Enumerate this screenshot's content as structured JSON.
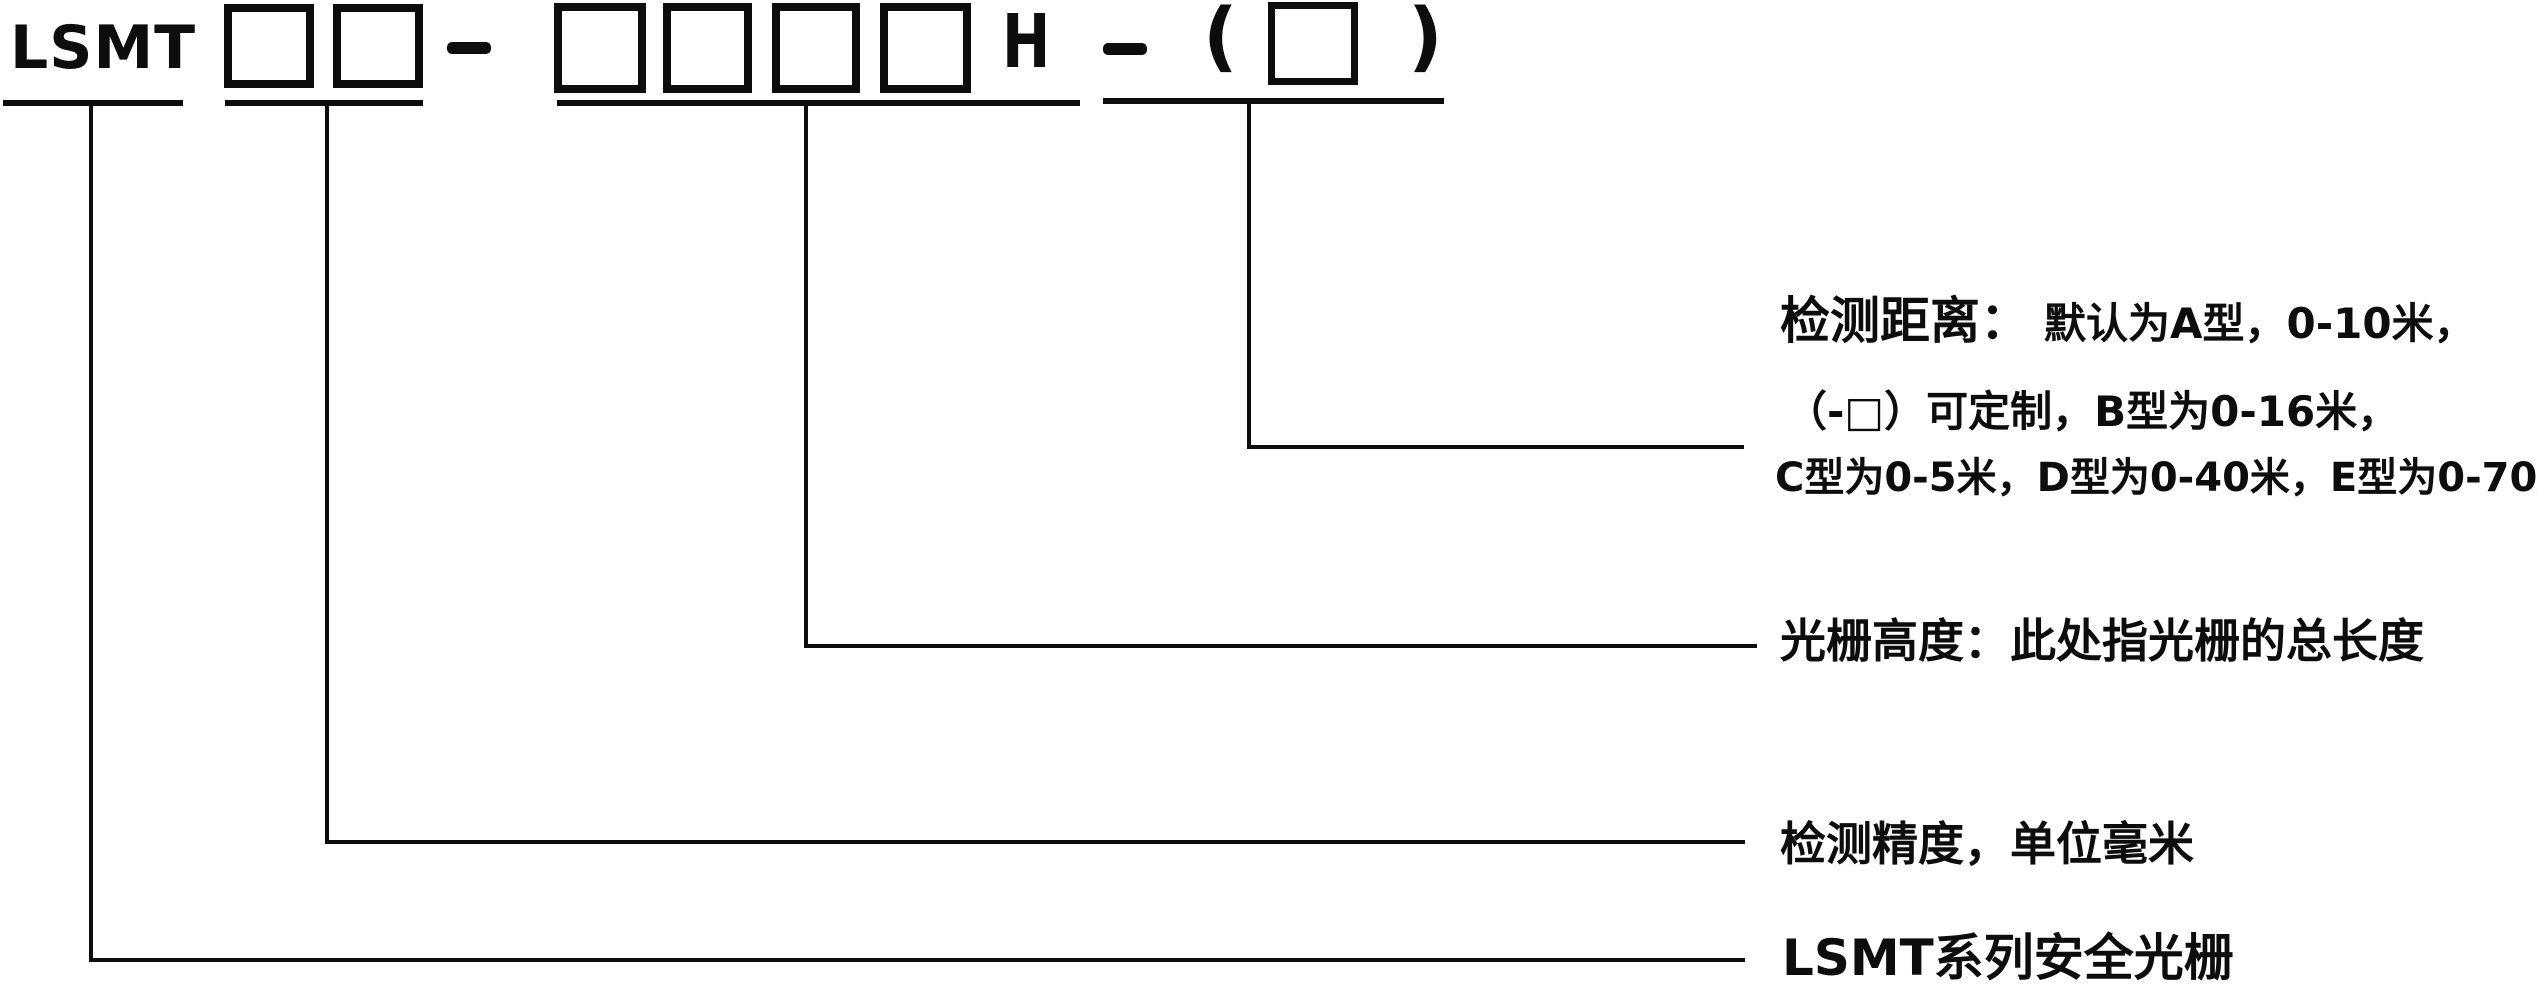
{
  "code": {
    "prefix": "LSMT",
    "height_suffix": "H",
    "separator": "-",
    "paren_open": "(",
    "paren_close": ")"
  },
  "labels": {
    "detection_distance": {
      "head": "检测距离：",
      "line1_rest": "默认为A型，0-10米，",
      "line2": "（-□）可定制，B型为0-16米，",
      "line3": "C型为0-5米，D型为0-40米，E型为0-70米"
    },
    "grating_height": "光栅高度：此处指光栅的总长度",
    "detection_accuracy": "检测精度，单位毫米",
    "series": "LSMT系列安全光栅"
  },
  "colors": {
    "ink": "#0d0d0d",
    "background": "#ffffff"
  }
}
